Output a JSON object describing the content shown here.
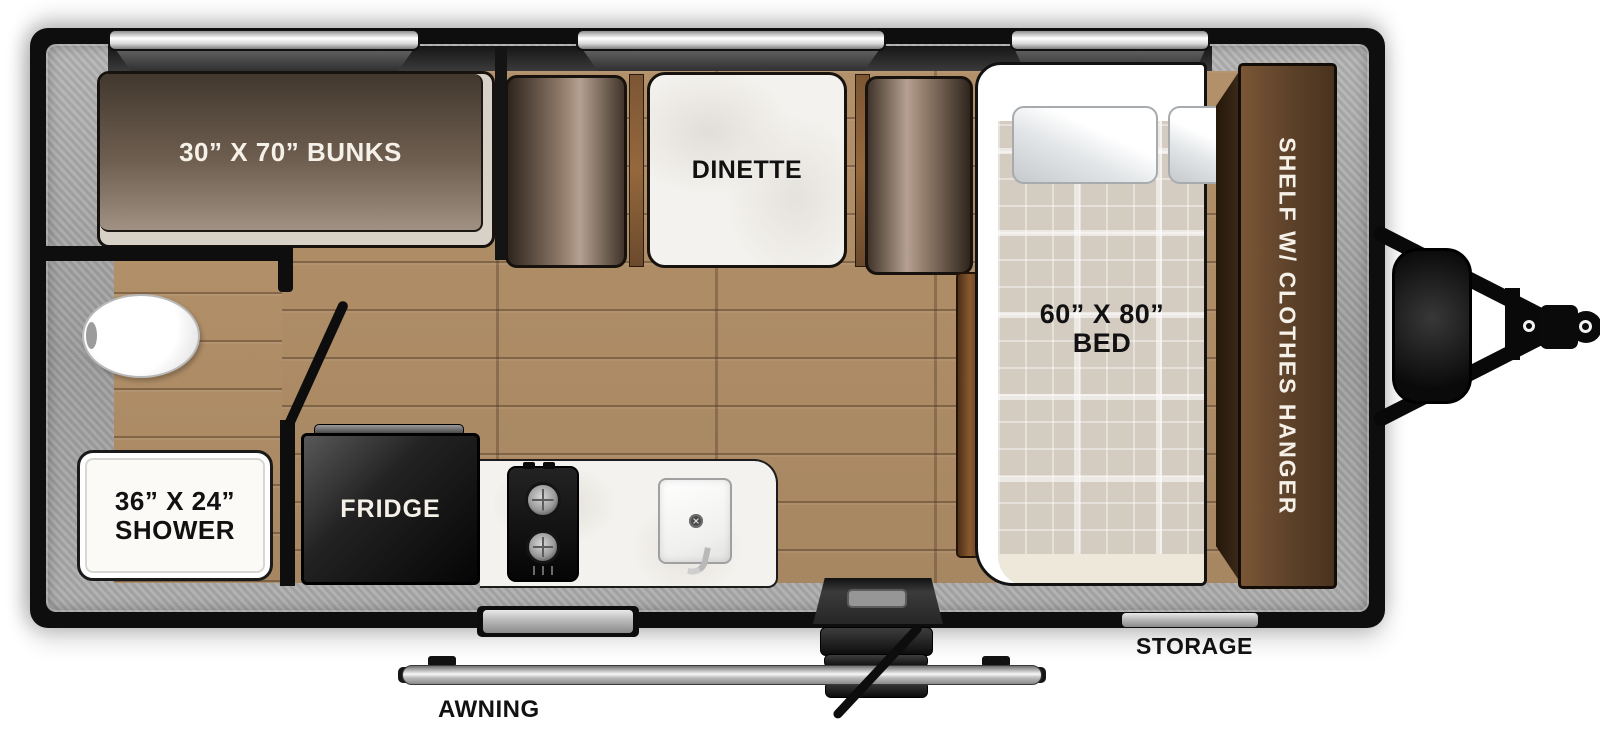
{
  "floorplan": {
    "bunks_label": "30” X 70” BUNKS",
    "dinette_label": "DINETTE",
    "bed_size_label": "60” X 80”",
    "bed_type_label": "BED",
    "shelf_label": "SHELF W/ CLOTHES HANGER",
    "shower_size_label": "36” X 24”",
    "shower_type_label": "SHOWER",
    "fridge_label": "FRIDGE",
    "awning_label": "AWNING",
    "storage_label": "STORAGE",
    "fixtures": [
      "toilet",
      "sink",
      "two-burner-stove",
      "entry-door-with-steps",
      "awning-rail",
      "storage-access-door",
      "propane-tank",
      "a-frame-hitch",
      "window-over-bunks",
      "window-over-dinette",
      "window-over-bed",
      "kitchen-window"
    ],
    "colors": {
      "shell_black": "#0e0e0e",
      "wall_gray": "#a8a8a8",
      "floor_wood": "#ac8a66",
      "upholstery_brown": "#8d7867",
      "cabinet_brown": "#5c4129",
      "mattress_plaid": "#d5ccc1",
      "counter_white": "#f4f2ee"
    }
  }
}
